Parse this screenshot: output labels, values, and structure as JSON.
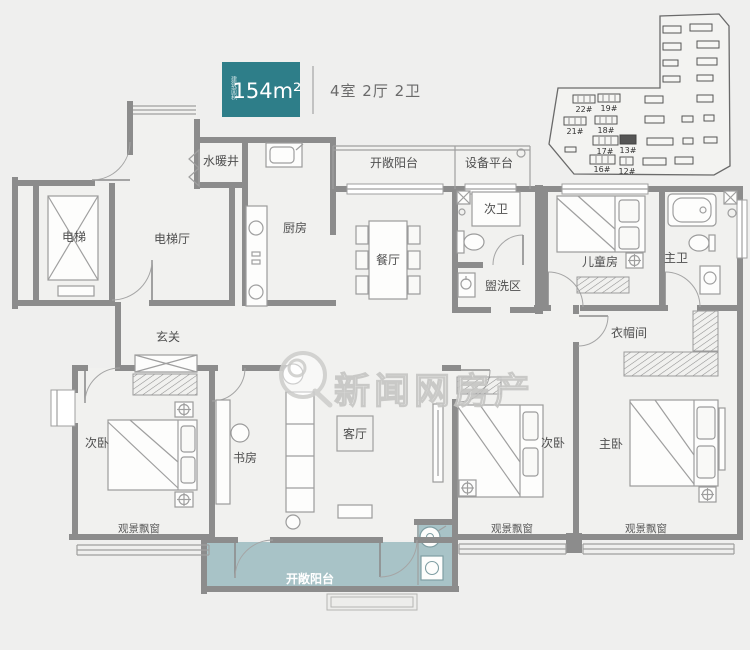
{
  "header": {
    "badge_area": "154m²",
    "badge_caption": "建筑面积",
    "unit_info": "4室 2厅 2卫"
  },
  "site_plan": {
    "buildings": [
      {
        "label": "22#"
      },
      {
        "label": "19#"
      },
      {
        "label": "21#"
      },
      {
        "label": "18#"
      },
      {
        "label": "17#"
      },
      {
        "label": "13#"
      },
      {
        "label": "16#"
      },
      {
        "label": "12#"
      }
    ],
    "highlighted_building": "13#"
  },
  "watermark": {
    "text": "新闻网房产"
  },
  "rooms": {
    "elevator": "电梯",
    "elevator_hall": "电梯厅",
    "utility_shaft": "水暖井",
    "kitchen": "厨房",
    "dining_room": "餐厅",
    "open_balcony_top": "开敞阳台",
    "equipment_platform": "设备平台",
    "second_bath": "次卫",
    "wash_area": "盥洗区",
    "kids_room": "儿童房",
    "master_bath": "主卫",
    "entry_hall": "玄关",
    "cloakroom": "衣帽间",
    "second_bedroom_left": "次卧",
    "study": "书房",
    "living_room": "客厅",
    "second_bedroom_right": "次卧",
    "master_bedroom": "主卧",
    "bay_window_left": "观景飘窗",
    "bay_window_mid": "观景飘窗",
    "bay_window_right": "观景飘窗",
    "open_balcony_bottom": "开敞阳台"
  },
  "colors": {
    "badge_bg": "#2e7e89",
    "wall": "#8c8c8c",
    "balcony_fill": "#a8c3c7",
    "background": "#efefee",
    "label_text": "#4f4f4f"
  }
}
